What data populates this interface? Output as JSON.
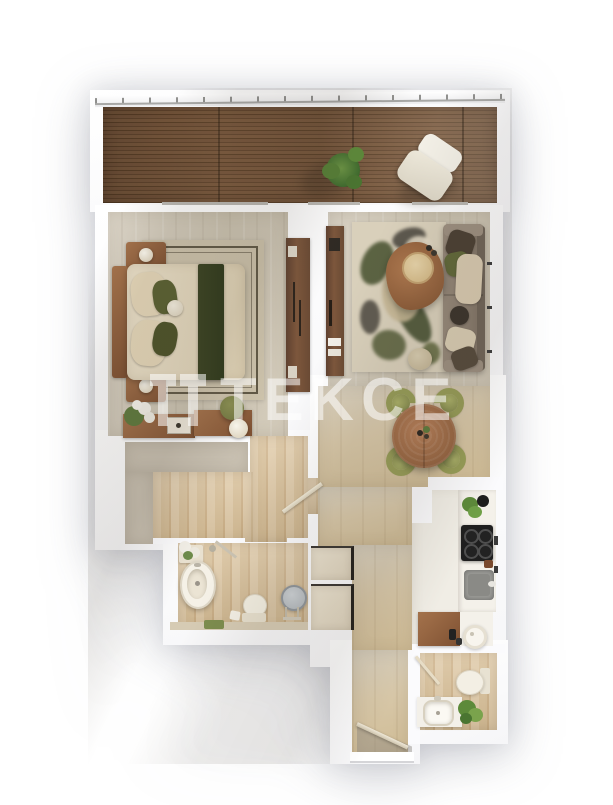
{
  "watermark": {
    "brand": "TEKCE",
    "logo_icon": "tekce-double-t-logo",
    "text_color": "#ffffff",
    "opacity": "0.55"
  },
  "palette": {
    "page_background": "#ffffff",
    "walls": "#fbfbfd",
    "outer_shadow": "#b9bac6",
    "balcony_deck_wood": "#6e4e35",
    "stone_floor": "#d3cbba",
    "oak_floor": "#d9c29d",
    "void_area": "#c9c1b2",
    "dark_wood_furniture": "#6e4a33",
    "mid_wood_furniture": "#9a6a45",
    "olive_green": "#8f9852",
    "bedding_green": "#3c4423",
    "textile_beige": "#e3d6ba",
    "sofa_gray": "#8a7d6f",
    "appliance_black": "#1f1f1f",
    "sink_gray": "#9c9c98",
    "plant_green": "#567f36"
  },
  "apartment": {
    "type": "one-bedroom-apartment-floor-plan-3d-top-view",
    "rooms": [
      {
        "id": "balcony",
        "items": [
          "wood-decking",
          "railing",
          "potted-plant",
          "lounge-chair"
        ]
      },
      {
        "id": "bedroom",
        "items": [
          "double-bed",
          "area-rug",
          "nightstand-top",
          "nightstand-bottom",
          "table-lamp-top",
          "table-lamp-bottom",
          "wardrobe",
          "sideboard",
          "flower-vase",
          "pouf",
          "sphere-lamp",
          "sliding-balcony-door"
        ]
      },
      {
        "id": "living-room",
        "items": [
          "sofa",
          "decor-pillows",
          "coffee-table",
          "area-rug",
          "tv-console",
          "floor-cushion",
          "sliding-balcony-doors",
          "wall-outlets"
        ]
      },
      {
        "id": "dining-area",
        "items": [
          "round-dining-table",
          "dining-chairs-x4",
          "table-centerpiece"
        ]
      },
      {
        "id": "kitchen",
        "items": [
          "counter",
          "cooktop",
          "sink",
          "plant",
          "wood-counter",
          "paper-roll",
          "jars"
        ]
      },
      {
        "id": "bathroom-main",
        "items": [
          "bathtub",
          "toilet",
          "standing-mirror",
          "vanity",
          "shower-arm",
          "bath-mat",
          "flowers"
        ]
      },
      {
        "id": "hallway",
        "items": [
          "storage-cabinet-upper",
          "storage-cabinet-lower",
          "bathroom-door",
          "void-area"
        ]
      },
      {
        "id": "bathroom-guest",
        "items": [
          "toilet",
          "vanity-sink",
          "plant",
          "door"
        ]
      },
      {
        "id": "entrance",
        "items": [
          "entry-door",
          "door-threshold"
        ]
      }
    ]
  }
}
